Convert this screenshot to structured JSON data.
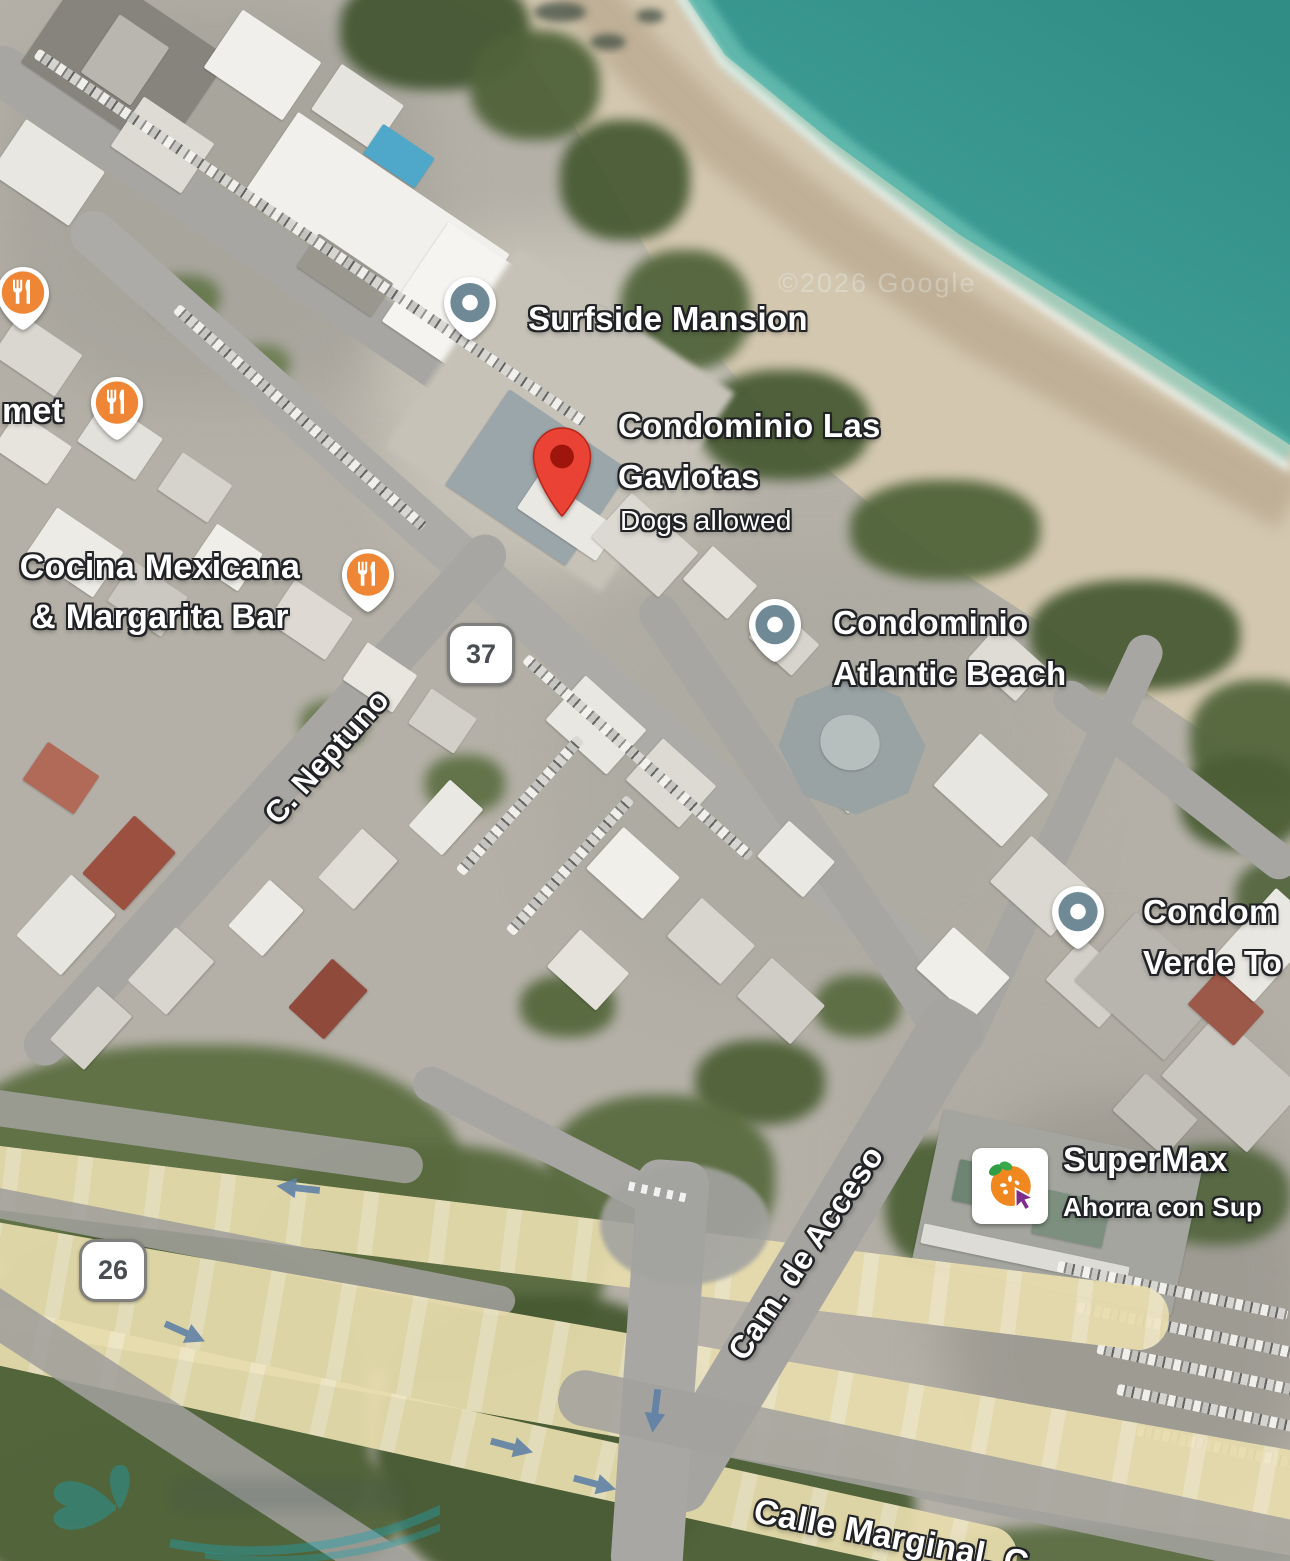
{
  "map_type": "satellite",
  "attribution": "©2026 Google",
  "colors": {
    "ocean_deep": "#2f8d86",
    "ocean_shallow": "#58b7ab",
    "sand": "#d3c7b0",
    "vegetation": "#51643a",
    "road_gray": "#a7a6a2",
    "highway_yellow": "#e8ddae",
    "place_marker_slate": "#6f8a96",
    "restaurant_marker_orange": "#ef8636",
    "destination_pin_red": "#ea4335",
    "traffic_arrow_blue": "#5d80a6",
    "label_text": "#ffffff",
    "label_outline": "#202124"
  },
  "shields": {
    "route37": "37",
    "route26": "26"
  },
  "streets": {
    "neptuno": "C. Neptuno",
    "acceso": "Cam. de Acceso",
    "marginal": "Calle Marginal, C"
  },
  "pois": {
    "surfside": {
      "name": "Surfside Mansion",
      "icon": "place-marker-icon"
    },
    "gaviotas": {
      "name": "Condominio Las\nGaviotas",
      "subtitle": "Dogs allowed",
      "icon": "destination-pin-icon"
    },
    "atlantic": {
      "name": "Condominio\nAtlantic Beach",
      "icon": "place-marker-icon"
    },
    "verde": {
      "name": "Condom\nVerde To",
      "icon": "place-marker-icon"
    },
    "supermax": {
      "name": "SuperMax",
      "subtitle": "Ahorra con Sup",
      "icon": "supermax-logo-icon"
    },
    "cocina": {
      "name": "Cocina Mexicana\n& Margarita Bar",
      "icon": "restaurant-icon"
    },
    "gourmet": {
      "name": "met",
      "icon": "restaurant-icon"
    }
  }
}
